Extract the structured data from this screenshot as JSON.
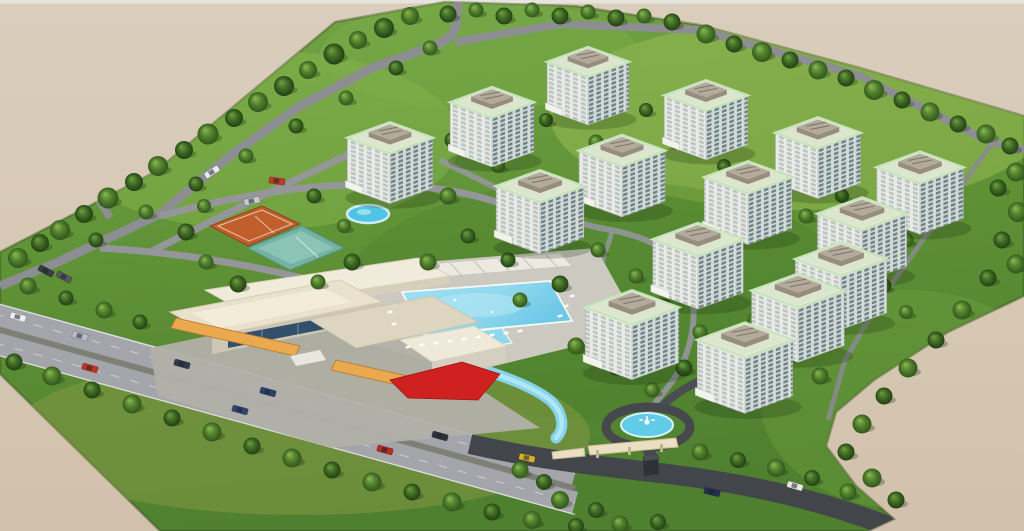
{
  "scene": {
    "title": "aerial-render-residential-complex-site-plan",
    "background_color": "#d6c8b4",
    "background_bottom_color": "#d2c1ac",
    "grass_color": "#5f9136",
    "site_polygon": "0,252 155,172 335,22 445,2 575,6 700,25 860,68 1024,116 1024,296 948,332 874,380 836,412 826,446 856,486 894,519 868,531 160,531 0,374",
    "towers": {
      "count": 15,
      "facade_left_color": "#e7eae5",
      "facade_right_color": "#d3dbd8",
      "roof_trim_color": "#c9e4bc",
      "roof_color": "#e3ecd8",
      "penthouse_color": "#b3aa9b",
      "window_color": "#2a4650",
      "entrance_canopy_color": "#f3f3ee",
      "positions": [
        [
          588,
          86
        ],
        [
          706,
          120
        ],
        [
          492,
          127
        ],
        [
          818,
          158
        ],
        [
          390,
          163
        ],
        [
          622,
          176
        ],
        [
          920,
          193
        ],
        [
          748,
          203
        ],
        [
          540,
          212
        ],
        [
          862,
          240
        ],
        [
          698,
          266
        ],
        [
          841,
          286
        ],
        [
          798,
          318
        ],
        [
          632,
          335
        ],
        [
          745,
          368
        ]
      ]
    },
    "amenities": {
      "swimming_pool": {
        "color": "#8fd8ee",
        "deck_color": "#ccc9c0"
      },
      "lazy_river": {
        "color": "#86d4ec"
      },
      "round_pond": {
        "color": "#4fc4e4",
        "cx": 368,
        "cy": 214
      },
      "fountain_pond": {
        "color": "#62cce8",
        "cx": 647,
        "cy": 425
      },
      "clay_tennis_court": {
        "color": "#c05e2c"
      },
      "hard_court": {
        "color": "#76b2a4"
      },
      "clubhouse": {
        "roof_color": "#e9e1cc",
        "awning_color": "#eaa94e",
        "glass_color": "#32506b",
        "red_canopy_color": "#cf2120",
        "plaza_color": "#b2b0a8"
      },
      "entrance_gate": {
        "color": "#eadfc2"
      }
    },
    "roads": {
      "perimeter_color": "#8d8e92",
      "internal_color": "#95969a",
      "highway_color": "#a4a5ab",
      "dark_road_color": "#42464b"
    },
    "trees": {
      "count": 131,
      "positions": [
        [
          18,
          258,
          1.0,
          0
        ],
        [
          40,
          243,
          0.9,
          1
        ],
        [
          60,
          230,
          1.0,
          0
        ],
        [
          84,
          214,
          0.9,
          1
        ],
        [
          108,
          198,
          1.05,
          0
        ],
        [
          134,
          182,
          0.9,
          1
        ],
        [
          158,
          166,
          1.0,
          0
        ],
        [
          184,
          150,
          0.9,
          1
        ],
        [
          208,
          134,
          1.05,
          0
        ],
        [
          234,
          118,
          0.9,
          1
        ],
        [
          258,
          102,
          1.0,
          0
        ],
        [
          284,
          86,
          1.0,
          1
        ],
        [
          308,
          70,
          0.9,
          0
        ],
        [
          334,
          54,
          1.05,
          1
        ],
        [
          358,
          40,
          0.9,
          0
        ],
        [
          384,
          28,
          1.0,
          1
        ],
        [
          410,
          16,
          0.9,
          0
        ],
        [
          96,
          240,
          0.75,
          1
        ],
        [
          146,
          212,
          0.75,
          0
        ],
        [
          196,
          184,
          0.75,
          1
        ],
        [
          246,
          156,
          0.75,
          0
        ],
        [
          296,
          126,
          0.75,
          1
        ],
        [
          346,
          98,
          0.75,
          0
        ],
        [
          396,
          68,
          0.75,
          1
        ],
        [
          430,
          48,
          0.75,
          0
        ],
        [
          448,
          14,
          0.85,
          1
        ],
        [
          476,
          10,
          0.75,
          0
        ],
        [
          504,
          16,
          0.85,
          1
        ],
        [
          532,
          10,
          0.75,
          0
        ],
        [
          560,
          16,
          0.85,
          1
        ],
        [
          588,
          12,
          0.75,
          0
        ],
        [
          616,
          18,
          0.85,
          1
        ],
        [
          644,
          16,
          0.75,
          0
        ],
        [
          672,
          22,
          0.85,
          1
        ],
        [
          706,
          34,
          0.95,
          0
        ],
        [
          734,
          44,
          0.85,
          1
        ],
        [
          762,
          52,
          1.0,
          0
        ],
        [
          790,
          60,
          0.85,
          1
        ],
        [
          818,
          70,
          0.95,
          0
        ],
        [
          846,
          78,
          0.85,
          1
        ],
        [
          874,
          90,
          1.0,
          0
        ],
        [
          902,
          100,
          0.85,
          1
        ],
        [
          930,
          112,
          0.95,
          0
        ],
        [
          958,
          124,
          0.85,
          1
        ],
        [
          986,
          134,
          0.95,
          0
        ],
        [
          1010,
          146,
          0.85,
          1
        ],
        [
          1016,
          172,
          0.95,
          0
        ],
        [
          998,
          188,
          0.85,
          1
        ],
        [
          1018,
          212,
          1.0,
          0
        ],
        [
          1002,
          240,
          0.85,
          1
        ],
        [
          1016,
          264,
          0.95,
          0
        ],
        [
          988,
          278,
          0.85,
          1
        ],
        [
          962,
          310,
          0.95,
          0
        ],
        [
          936,
          340,
          0.85,
          1
        ],
        [
          908,
          368,
          0.95,
          0
        ],
        [
          884,
          396,
          0.85,
          1
        ],
        [
          862,
          424,
          0.95,
          0
        ],
        [
          846,
          452,
          0.85,
          1
        ],
        [
          872,
          478,
          0.95,
          0
        ],
        [
          896,
          500,
          0.85,
          1
        ],
        [
          14,
          362,
          0.85,
          1
        ],
        [
          52,
          376,
          0.95,
          0
        ],
        [
          92,
          390,
          0.85,
          1
        ],
        [
          132,
          404,
          0.95,
          0
        ],
        [
          172,
          418,
          0.85,
          1
        ],
        [
          212,
          432,
          0.95,
          0
        ],
        [
          252,
          446,
          0.85,
          1
        ],
        [
          292,
          458,
          0.95,
          0
        ],
        [
          332,
          470,
          0.85,
          1
        ],
        [
          372,
          482,
          0.95,
          0
        ],
        [
          412,
          492,
          0.85,
          1
        ],
        [
          452,
          502,
          0.95,
          0
        ],
        [
          492,
          512,
          0.85,
          1
        ],
        [
          532,
          520,
          0.9,
          0
        ],
        [
          576,
          526,
          0.8,
          1
        ],
        [
          620,
          524,
          0.85,
          0
        ],
        [
          658,
          522,
          0.8,
          1
        ],
        [
          520,
          470,
          0.85,
          0
        ],
        [
          544,
          482,
          0.8,
          1
        ],
        [
          560,
          500,
          0.9,
          0
        ],
        [
          596,
          510,
          0.8,
          1
        ],
        [
          28,
          286,
          0.85,
          0
        ],
        [
          66,
          298,
          0.75,
          1
        ],
        [
          104,
          310,
          0.85,
          0
        ],
        [
          140,
          322,
          0.75,
          1
        ],
        [
          700,
          452,
          0.85,
          0
        ],
        [
          738,
          460,
          0.8,
          1
        ],
        [
          776,
          468,
          0.9,
          0
        ],
        [
          812,
          478,
          0.8,
          1
        ],
        [
          848,
          492,
          0.85,
          0
        ],
        [
          448,
          196,
          0.85,
          0
        ],
        [
          468,
          236,
          0.75,
          1
        ],
        [
          428,
          262,
          0.85,
          0
        ],
        [
          508,
          260,
          0.75,
          1
        ],
        [
          598,
          250,
          0.75,
          0
        ],
        [
          560,
          284,
          0.85,
          1
        ],
        [
          520,
          300,
          0.75,
          0
        ],
        [
          600,
          318,
          0.75,
          1
        ],
        [
          576,
          346,
          0.85,
          0
        ],
        [
          616,
          368,
          0.75,
          1
        ],
        [
          652,
          390,
          0.75,
          0
        ],
        [
          684,
          368,
          0.85,
          1
        ],
        [
          712,
          390,
          0.75,
          0
        ],
        [
          718,
          344,
          0.75,
          1
        ],
        [
          756,
          320,
          0.85,
          0
        ],
        [
          786,
          356,
          0.75,
          1
        ],
        [
          820,
          376,
          0.85,
          0
        ],
        [
          760,
          386,
          0.75,
          1
        ],
        [
          700,
          332,
          0.75,
          0
        ],
        [
          664,
          306,
          0.75,
          1
        ],
        [
          636,
          276,
          0.75,
          0
        ],
        [
          186,
          232,
          0.85,
          1
        ],
        [
          206,
          262,
          0.75,
          0
        ],
        [
          238,
          284,
          0.85,
          1
        ],
        [
          318,
          282,
          0.75,
          0
        ],
        [
          352,
          262,
          0.85,
          1
        ],
        [
          204,
          206,
          0.7,
          0
        ],
        [
          314,
          196,
          0.75,
          1
        ],
        [
          344,
          226,
          0.7,
          0
        ],
        [
          452,
          140,
          0.75,
          1
        ],
        [
          498,
          166,
          0.7,
          0
        ],
        [
          546,
          120,
          0.7,
          1
        ],
        [
          596,
          142,
          0.75,
          0
        ],
        [
          646,
          110,
          0.7,
          1
        ],
        [
          676,
          142,
          0.75,
          0
        ],
        [
          724,
          166,
          0.7,
          1
        ],
        [
          806,
          216,
          0.75,
          0
        ],
        [
          842,
          196,
          0.7,
          1
        ],
        [
          906,
          240,
          0.75,
          0
        ],
        [
          884,
          286,
          0.75,
          1
        ],
        [
          906,
          312,
          0.7,
          0
        ]
      ]
    },
    "cars": [
      [
        18,
        317,
        15.5,
        "#eceef0"
      ],
      [
        80,
        336,
        15.5,
        "#b9bcc2"
      ],
      [
        182,
        364,
        15.5,
        "#34394a"
      ],
      [
        268,
        392,
        15.5,
        "#2e4070"
      ],
      [
        440,
        436,
        15.5,
        "#2f3338"
      ],
      [
        90,
        368,
        15.5,
        "#c03226"
      ],
      [
        240,
        410,
        15.5,
        "#32466f"
      ],
      [
        385,
        450,
        15.5,
        "#b52c20"
      ],
      [
        795,
        486,
        16,
        "#eae6de"
      ],
      [
        712,
        492,
        14,
        "#22304f"
      ],
      [
        527,
        458,
        13,
        "#d4b32c"
      ],
      [
        46,
        271,
        28,
        "#3a3d42"
      ],
      [
        64,
        277,
        28,
        "#55595f"
      ],
      [
        277,
        181,
        8,
        "#c0392b"
      ],
      [
        212,
        172,
        -33,
        "#e8eaec"
      ],
      [
        252,
        201,
        -12,
        "#c6c8cb"
      ]
    ],
    "pool_chairs": [
      [
        408,
        347
      ],
      [
        422,
        345
      ],
      [
        436,
        343
      ],
      [
        450,
        341
      ],
      [
        464,
        339
      ],
      [
        478,
        337
      ],
      [
        492,
        335
      ],
      [
        506,
        333
      ],
      [
        520,
        331
      ],
      [
        560,
        316
      ],
      [
        566,
        306
      ],
      [
        572,
        296
      ],
      [
        390,
        312
      ],
      [
        394,
        324
      ]
    ]
  }
}
